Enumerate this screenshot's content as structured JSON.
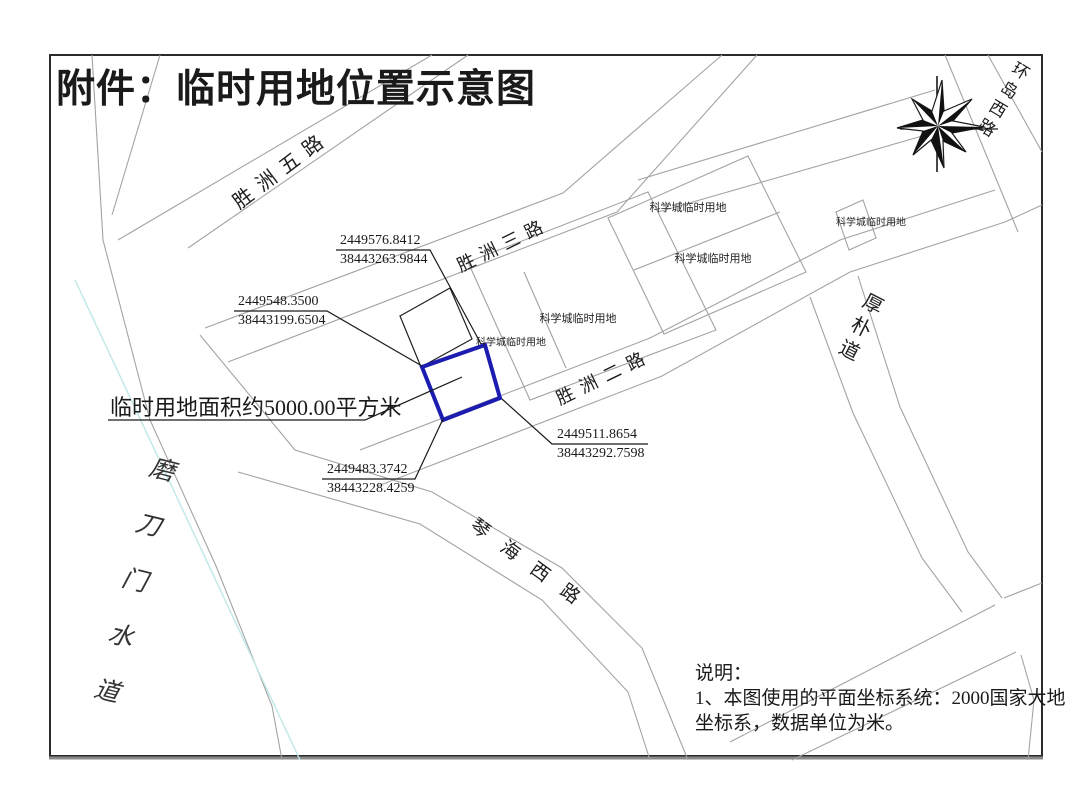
{
  "title": "附件：临时用地位置示意图",
  "roads": {
    "shengzhou5": "胜洲五路",
    "shengzhou3": "胜洲三路",
    "shengzhou2": "胜洲二路",
    "qinhaixi": "琴海西路",
    "houpu": "厚朴道",
    "huandaoxi": "环岛西路",
    "modaomen_waterway": "磨刀门水道"
  },
  "parcels": {
    "science_city_label": "科学城临时用地"
  },
  "site": {
    "area_label": "临时用地面积约5000.00平方米"
  },
  "coordinates": [
    {
      "x": "2449576.8412",
      "y": "38443263.9844"
    },
    {
      "x": "2449548.3500",
      "y": "38443199.6504"
    },
    {
      "x": "2449511.8654",
      "y": "38443292.7598"
    },
    {
      "x": "2449483.3742",
      "y": "38443228.4259"
    }
  ],
  "notes": {
    "heading": "说明：",
    "line1": "1、本图使用的平面坐标系统：2000国家大地",
    "line2": "坐标系，数据单位为米。"
  },
  "colors": {
    "parcel_highlight": "#1c1cb0",
    "road_line": "#a3a3a3",
    "water_line": "#bfe7e7",
    "ink": "#1a1a1a"
  }
}
